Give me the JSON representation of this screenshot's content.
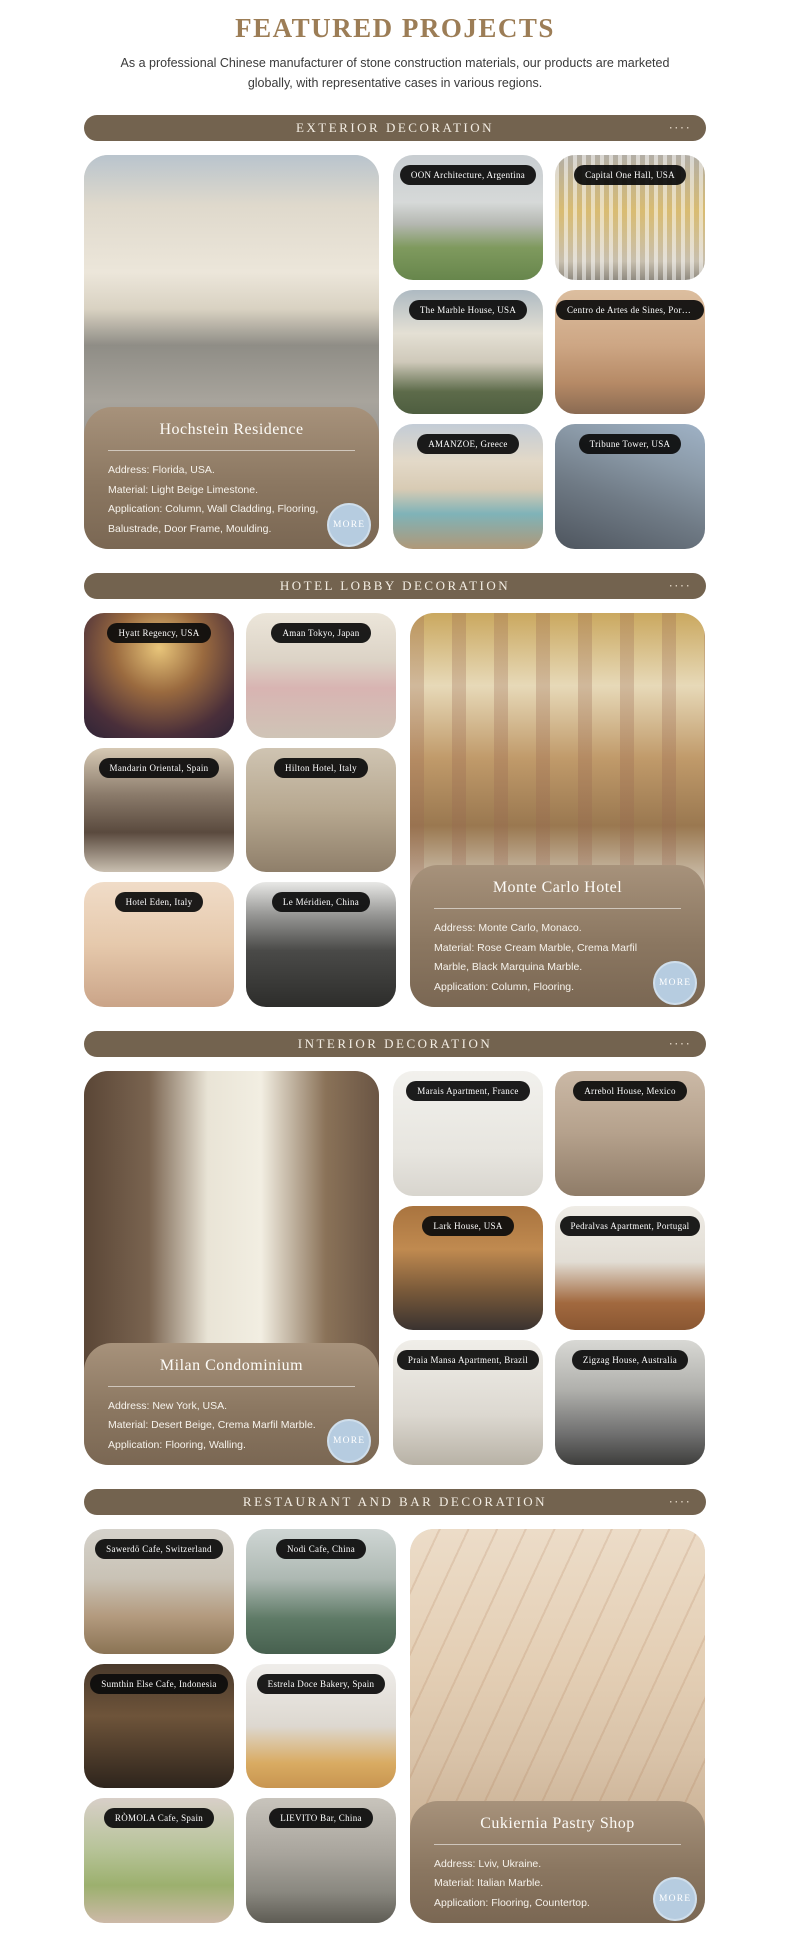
{
  "header": {
    "title": "FEATURED PROJECTS",
    "subtitle": "As a professional Chinese manufacturer of stone construction materials, our products are marketed globally, with representative cases in various regions."
  },
  "ui": {
    "dots": "····",
    "more_label": "MORE"
  },
  "colors": {
    "accent_brown": "#73634f",
    "title_gold": "#9c7d56",
    "info_panel_brown": "#8b7761",
    "more_button_blue": "#b6cce0",
    "label_pill_black": "#0c0c0c"
  },
  "sections": [
    {
      "title": "EXTERIOR DECORATION",
      "featured": {
        "name": "Hochstein Residence",
        "details": [
          "Address: Florida, USA.",
          "Material: Light Beige Limestone.",
          "Application: Column, Wall Cladding, Flooring,",
          "Balustrade, Door Frame, Moulding."
        ]
      },
      "projects": [
        "OON Architecture, Argentina",
        "Capital One Hall, USA",
        "The Marble House, USA",
        "Centro de Artes de Sines, Portugal",
        "AMANZOE, Greece",
        "Tribune Tower, USA"
      ]
    },
    {
      "title": "HOTEL LOBBY DECORATION",
      "featured": {
        "name": "Monte Carlo Hotel",
        "details": [
          "Address: Monte Carlo, Monaco.",
          "Material: Rose Cream Marble, Crema Marfil",
          "Marble, Black Marquina Marble.",
          "Application: Column, Flooring."
        ]
      },
      "projects": [
        "Hyatt Regency, USA",
        "Aman Tokyo, Japan",
        "Mandarin Oriental, Spain",
        "Hilton Hotel, Italy",
        "Hotel Eden, Italy",
        "Le Méridien, China"
      ]
    },
    {
      "title": "INTERIOR DECORATION",
      "featured": {
        "name": "Milan Condominium",
        "details": [
          "Address: New York, USA.",
          "Material: Desert Beige, Crema Marfil Marble.",
          "Application: Flooring, Walling."
        ]
      },
      "projects": [
        "Marais Apartment, France",
        "Arrebol House, Mexico",
        "Lark House, USA",
        "Pedralvas Apartment, Portugal",
        "Praia Mansa Apartment, Brazil",
        "Zigzag House, Australia"
      ]
    },
    {
      "title": "RESTAURANT AND BAR DECORATION",
      "featured": {
        "name": "Cukiernia Pastry Shop",
        "details": [
          "Address: Lviv, Ukraine.",
          "Material: Italian Marble.",
          "Application: Flooring, Countertop."
        ]
      },
      "projects": [
        "Sawerdö Cafe, Switzerland",
        "Nodi Cafe, China",
        "Sumthin Else Cafe, Indonesia",
        "Estrela Doce Bakery, Spain",
        "RÒMOLA Cafe, Spain",
        "LIEVITO Bar, China"
      ]
    }
  ]
}
